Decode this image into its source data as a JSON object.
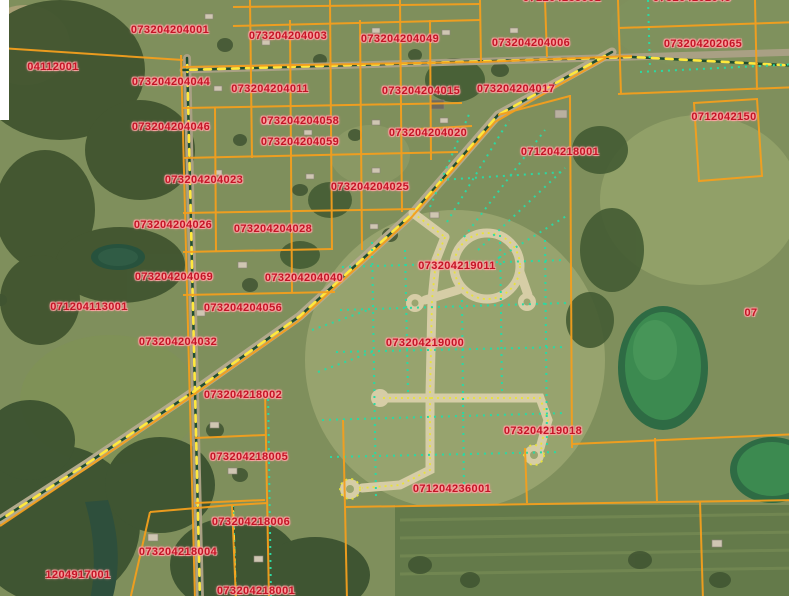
{
  "map": {
    "description": "County GIS parcel viewer - aerial imagery with parcel overlay",
    "colors": {
      "parcel_line": "#f49f1d",
      "label_text": "#c41426",
      "label_halo": "#ff9d9d",
      "lot_line_dotted": "#2bd9a2",
      "road_dash_yellow": "#ffe93c",
      "road_dash_dark": "#1f4d2e",
      "pond_green": "#3c8a50",
      "street_pavement": "#d6cda6"
    },
    "parcel_labels": [
      {
        "id": "071204235001",
        "cx": 562,
        "cy": -2,
        "partial": true
      },
      {
        "id": "073204202045",
        "cx": 692,
        "cy": -2,
        "partial": true
      },
      {
        "id": "073204204001",
        "cx": 170,
        "cy": 30
      },
      {
        "id": "073204204003",
        "cx": 288,
        "cy": 36
      },
      {
        "id": "073204204049",
        "cx": 400,
        "cy": 39
      },
      {
        "id": "073204204006",
        "cx": 531,
        "cy": 43
      },
      {
        "id": "073204202065",
        "cx": 703,
        "cy": 44
      },
      {
        "id": "04112001",
        "cx": 53,
        "cy": 67,
        "partial": true
      },
      {
        "id": "073204204044",
        "cx": 171,
        "cy": 82
      },
      {
        "id": "073204204011",
        "cx": 270,
        "cy": 89
      },
      {
        "id": "073204204015",
        "cx": 421,
        "cy": 91
      },
      {
        "id": "073204204017",
        "cx": 516,
        "cy": 89
      },
      {
        "id": "0712042150",
        "cx": 724,
        "cy": 117,
        "partial": true
      },
      {
        "id": "073204204058",
        "cx": 300,
        "cy": 121
      },
      {
        "id": "073204204046",
        "cx": 171,
        "cy": 127
      },
      {
        "id": "073204204020",
        "cx": 428,
        "cy": 133
      },
      {
        "id": "073204204059",
        "cx": 300,
        "cy": 142
      },
      {
        "id": "071204218001",
        "cx": 560,
        "cy": 152
      },
      {
        "id": "073204204023",
        "cx": 204,
        "cy": 180
      },
      {
        "id": "073204204025",
        "cx": 370,
        "cy": 187
      },
      {
        "id": "073204204026",
        "cx": 173,
        "cy": 225
      },
      {
        "id": "073204204028",
        "cx": 273,
        "cy": 229
      },
      {
        "id": "073204219011",
        "cx": 457,
        "cy": 266
      },
      {
        "id": "073204204069",
        "cx": 174,
        "cy": 277
      },
      {
        "id": "073204204040",
        "cx": 304,
        "cy": 278
      },
      {
        "id": "071204113001",
        "cx": 89,
        "cy": 307
      },
      {
        "id": "073204204056",
        "cx": 243,
        "cy": 308
      },
      {
        "id": "07",
        "cx": 751,
        "cy": 313,
        "partial": true
      },
      {
        "id": "073204204032",
        "cx": 178,
        "cy": 342
      },
      {
        "id": "073204219000",
        "cx": 425,
        "cy": 343
      },
      {
        "id": "073204218002",
        "cx": 243,
        "cy": 395
      },
      {
        "id": "073204219018",
        "cx": 543,
        "cy": 431
      },
      {
        "id": "073204218005",
        "cx": 249,
        "cy": 457
      },
      {
        "id": "071204236001",
        "cx": 452,
        "cy": 489
      },
      {
        "id": "073204218006",
        "cx": 251,
        "cy": 522
      },
      {
        "id": "073204218004",
        "cx": 178,
        "cy": 552
      },
      {
        "id": "1204917001",
        "cx": 78,
        "cy": 575,
        "partial": true
      },
      {
        "id": "073204218001",
        "cx": 256,
        "cy": 591
      }
    ]
  }
}
